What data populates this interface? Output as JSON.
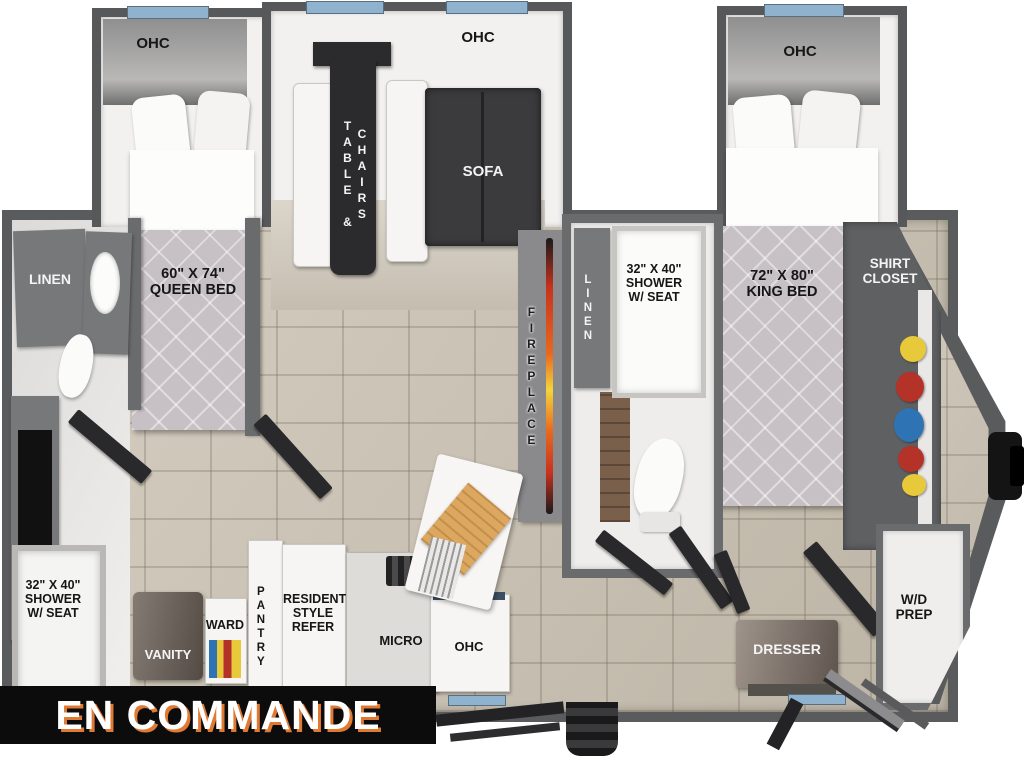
{
  "banner": {
    "label": "EN COMMANDE",
    "bg": "#0c0c0c",
    "text_color": "#ffffff",
    "shadow_color": "#e07a33"
  },
  "plan": {
    "rear_bedroom": {
      "ohc": "OHC",
      "bed": "60\" X 74\"\nQUEEN BED"
    },
    "dinette": {
      "ohc": "OHC",
      "table_col1": "TABLE &",
      "table_col2": "CHAIRS",
      "sofa": "SOFA"
    },
    "living": {
      "fireplace": "FIREPLACE"
    },
    "rear_bath": {
      "linen": "LINEN",
      "shower": "32\" X 40\"\nSHOWER\nW/ SEAT",
      "vanity": "VANITY",
      "ward": "WARD"
    },
    "mid_bath": {
      "linen": "LINEN",
      "shower": "32\" X 40\"\nSHOWER\nW/ SEAT"
    },
    "kitchen": {
      "pantry": "PANTRY",
      "refer": "RESIDENTIAL\nSTYLE\nREFER",
      "micro": "MICRO",
      "ohc": "OHC"
    },
    "front_bedroom": {
      "ohc": "OHC",
      "bed": "72\" X 80\"\nKING BED",
      "dresser": "DRESSER",
      "shirt_closet": "SHIRT\nCLOSET"
    },
    "utility": {
      "wd_prep": "W/D\nPREP"
    }
  },
  "colors": {
    "wall_gray": "#57585a",
    "floor_tan": "#cbc2b2",
    "window_blue": "#8fb3cf",
    "dark_furniture": "#2b2b2d",
    "flame_orange": "#e8691d",
    "flame_yellow": "#f5d43c",
    "vanity_brown": "#6f645b",
    "clothes": [
      "#e8c93a",
      "#b43228",
      "#2e74b5",
      "#b43228",
      "#e8c93a"
    ]
  }
}
